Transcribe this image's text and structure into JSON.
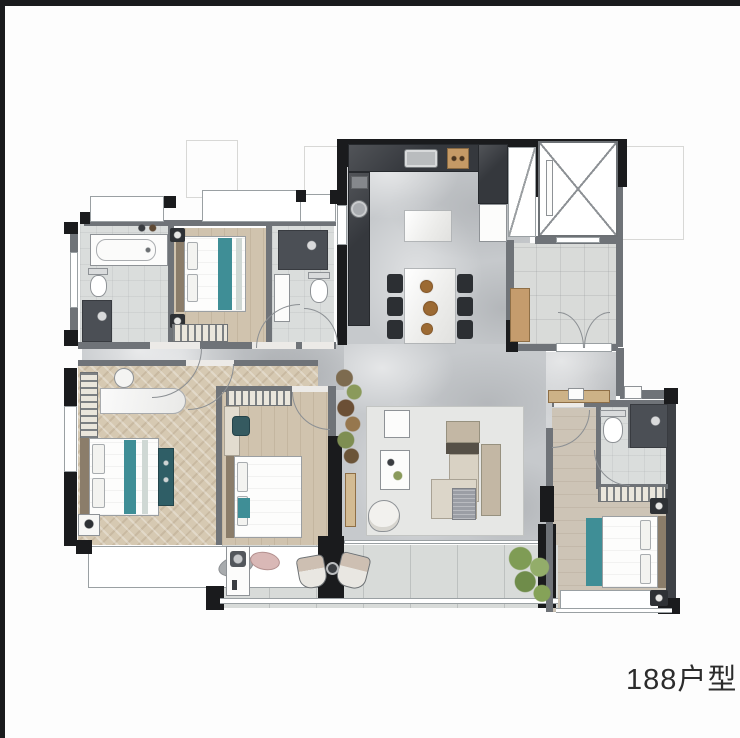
{
  "caption": {
    "unit_label": "188户型"
  },
  "palette": {
    "wall": "#1a1b1d",
    "gwall": "#6f7378",
    "marble": "#c6c9cc",
    "wood": "#d0c3ae",
    "tile": "#d9dbd9",
    "counter": "#35383d",
    "teal": "#3f8e96",
    "tan": "#c59c6d",
    "green": "#85a258"
  },
  "plan": {
    "type": "residential-floor-plan",
    "depicted_rooms": [
      "bathroom-with-tub",
      "bedroom-top",
      "bathroom-small",
      "kitchen",
      "elevator-shaft",
      "entry-hall",
      "dining-area",
      "living-room",
      "master-bedroom",
      "bedroom-middle",
      "bedroom-right",
      "bathroom-right",
      "balcony",
      "bay-window"
    ]
  }
}
